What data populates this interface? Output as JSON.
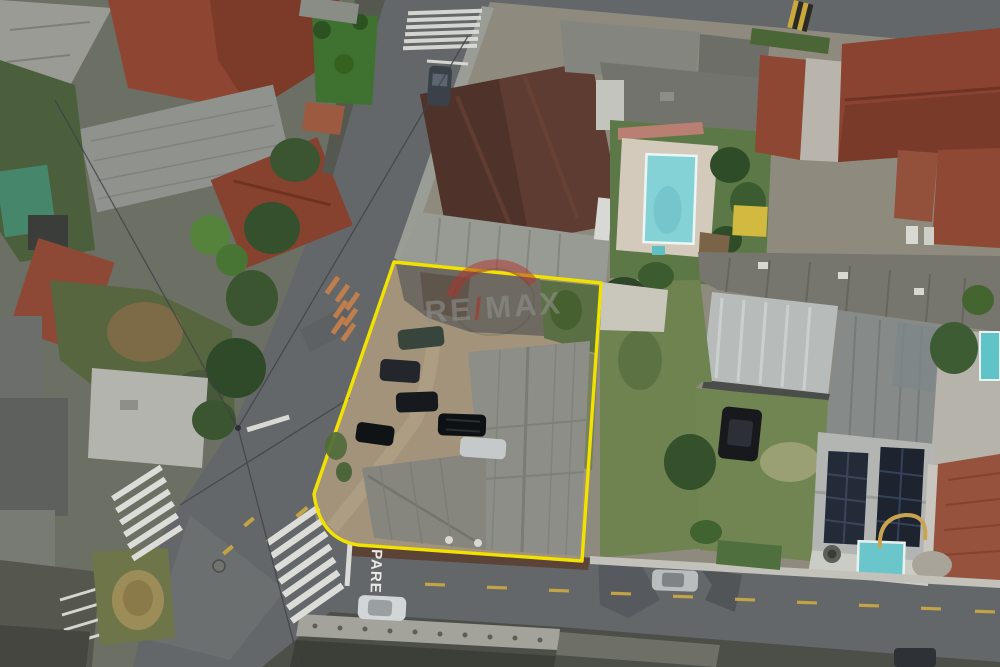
{
  "meta": {
    "type": "aerial-drone-photograph",
    "subject": "residential city block with a land parcel outlined for sale",
    "alt": "Aerial top-down view of houses, roads and a dirt lot outlined in yellow with a RE/MAX watermark"
  },
  "watermark": {
    "brand": "RE/MAX",
    "re": "RE",
    "slash": "/",
    "max": "MAX"
  },
  "road": {
    "stop_text": "PARE"
  },
  "boundary": {
    "color": "#f2e200",
    "shape": "rounded-corner quadrilateral"
  },
  "palette": {
    "asphalt": "#63676a",
    "lot_dirt": "#a2937a",
    "grass": "#6f8351",
    "roof_red": "#8e4532",
    "roof_brown": "#5f3c31",
    "roof_gray": "#8d8d88",
    "metal_roof": "#b7bcba",
    "pool_water": "#7fd0d4",
    "marking_white": "#dcdcd8",
    "marking_yellow": "#c2a345",
    "solar_panel": "#232a38"
  },
  "objects": {
    "pools": 3,
    "cars_inside_lot": 6,
    "cars_on_streets": 4,
    "crosswalks": 4,
    "solar_arrays": 2
  }
}
